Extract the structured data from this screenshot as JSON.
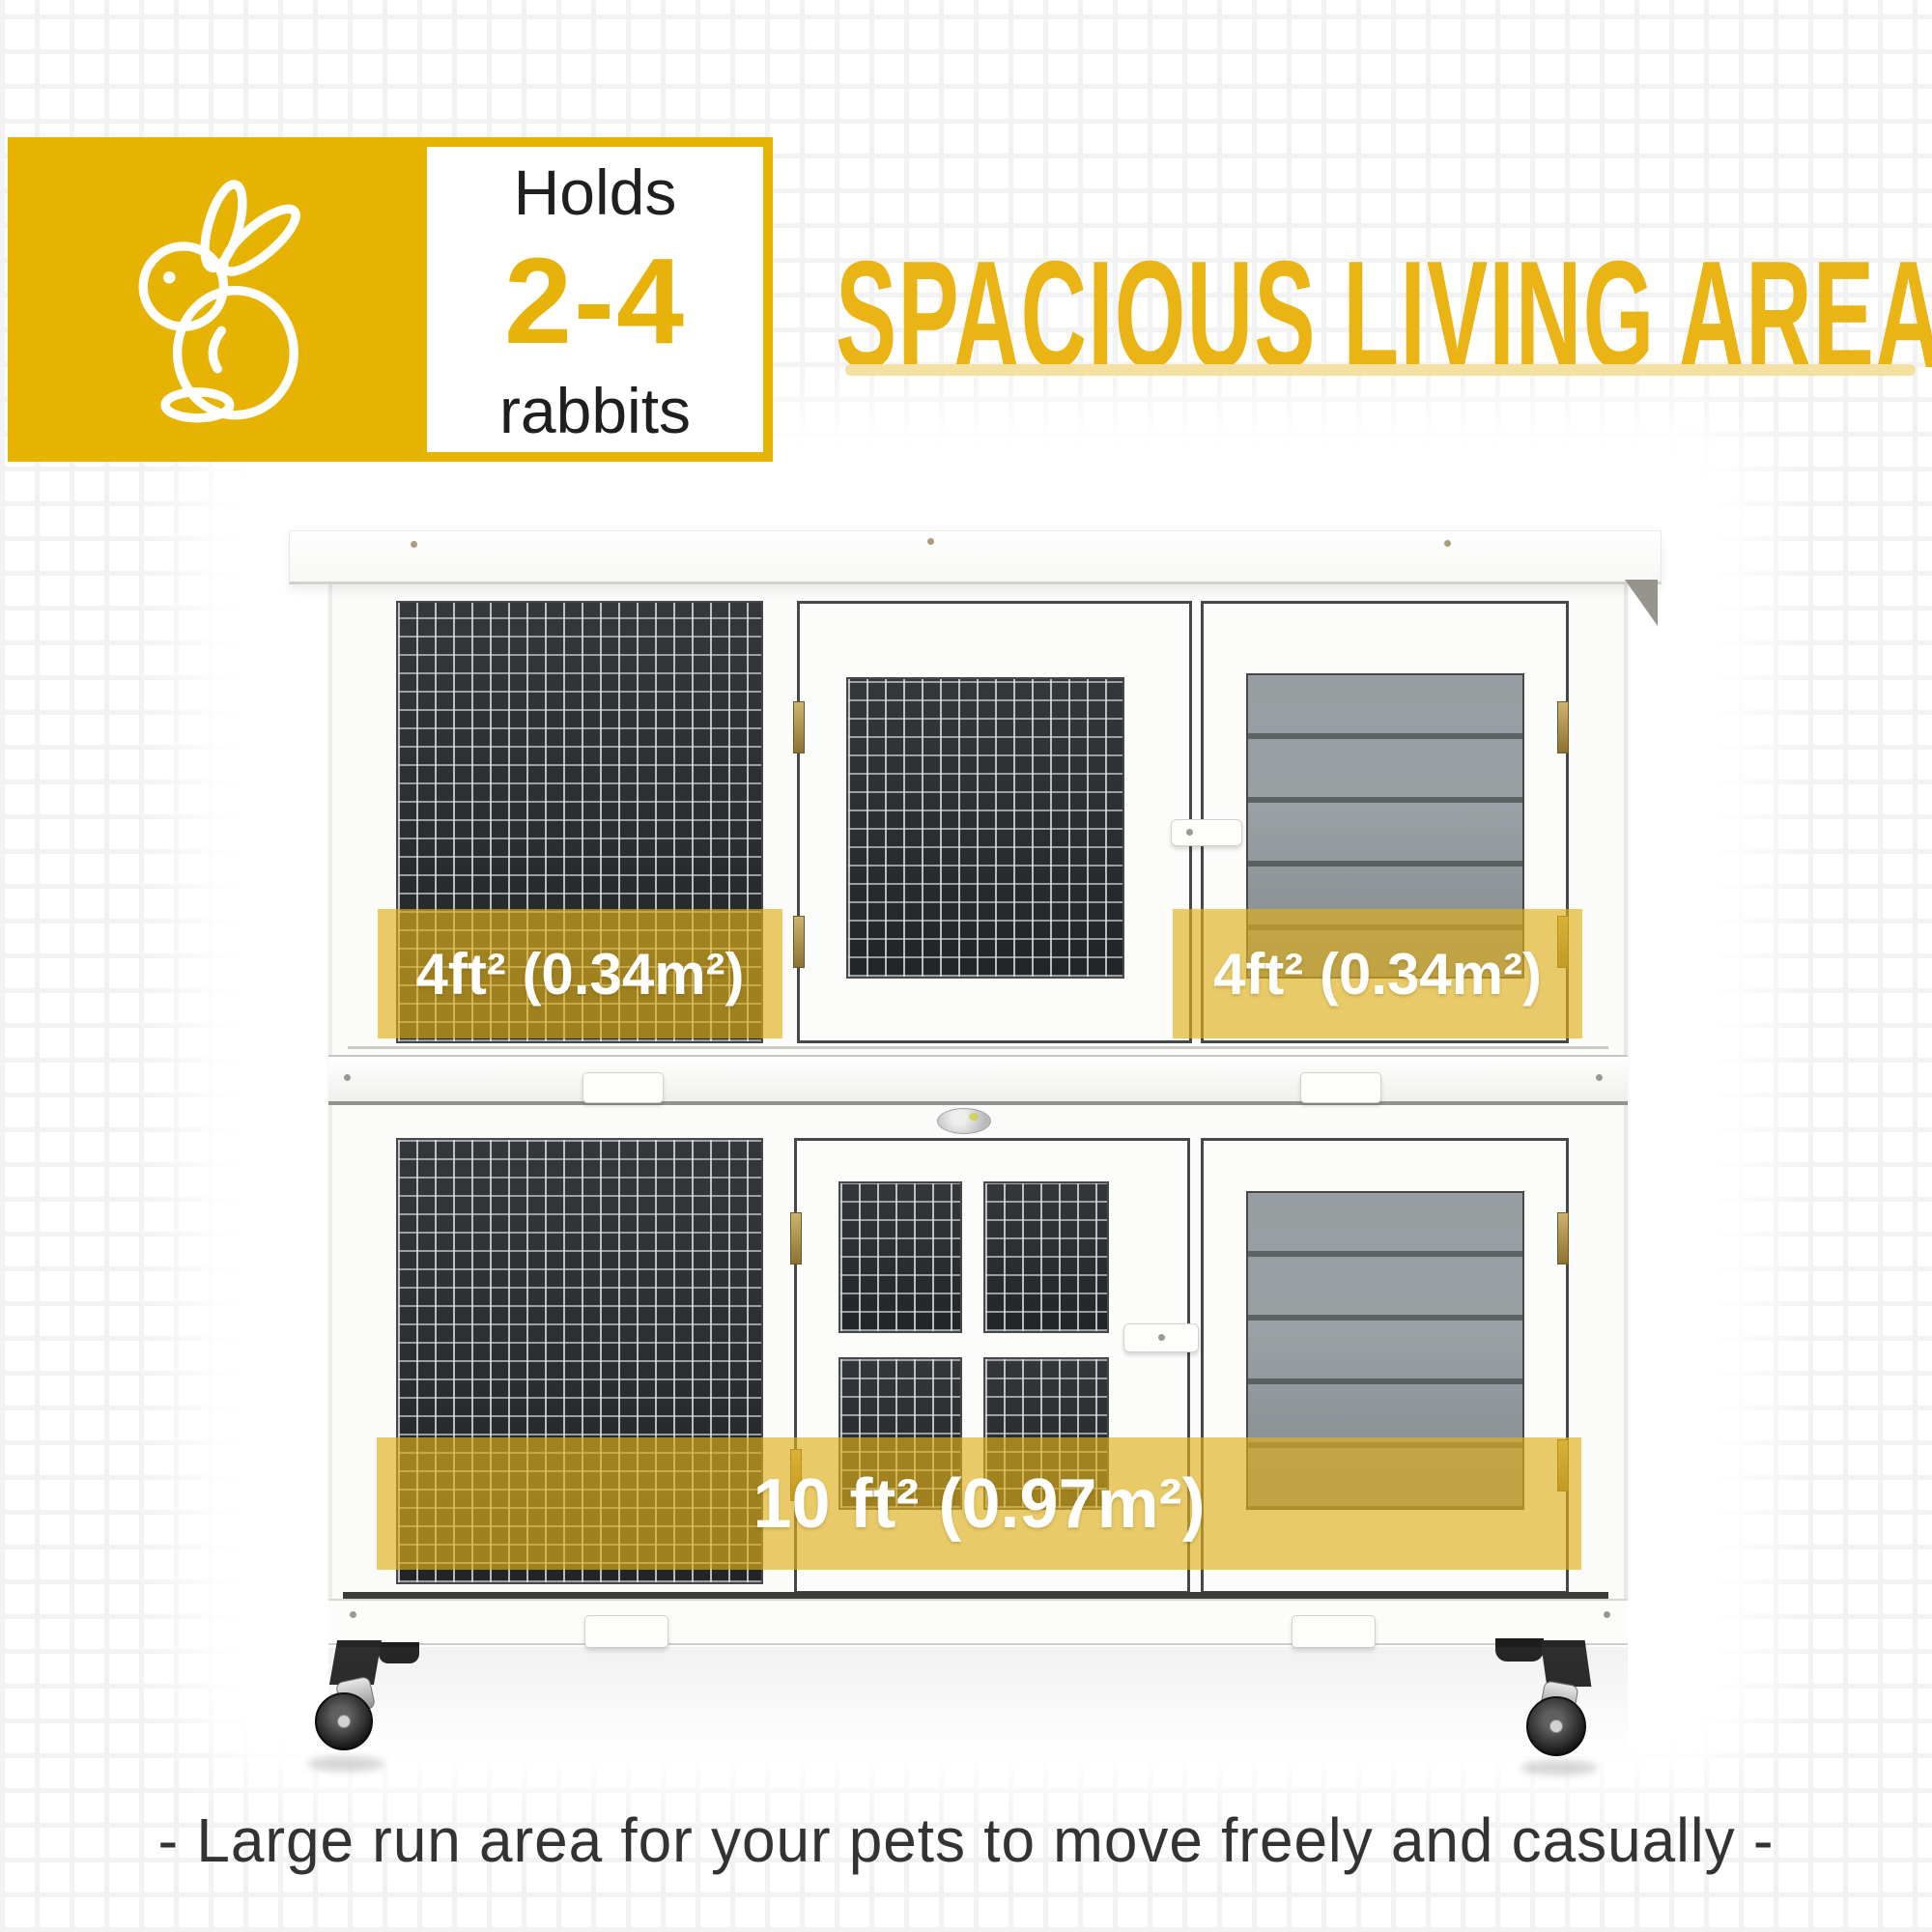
{
  "badge": {
    "holds_label": "Holds",
    "capacity": "2-4",
    "animal_label": "rabbits",
    "block_color": "#e7b302"
  },
  "header": {
    "title": "SPACIOUS LIVING AREA",
    "title_color": "#e9b414",
    "underline_color": "#f4e1a2"
  },
  "labels": {
    "upper_left": "4ft² (0.34m²)",
    "upper_right": "4ft² (0.34m²)",
    "lower": "10 ft² (0.97m²)",
    "overlay_color": "rgba(223,176,28,0.66)"
  },
  "caption": {
    "text": "- Large run area for your pets to move freely and casually -"
  }
}
